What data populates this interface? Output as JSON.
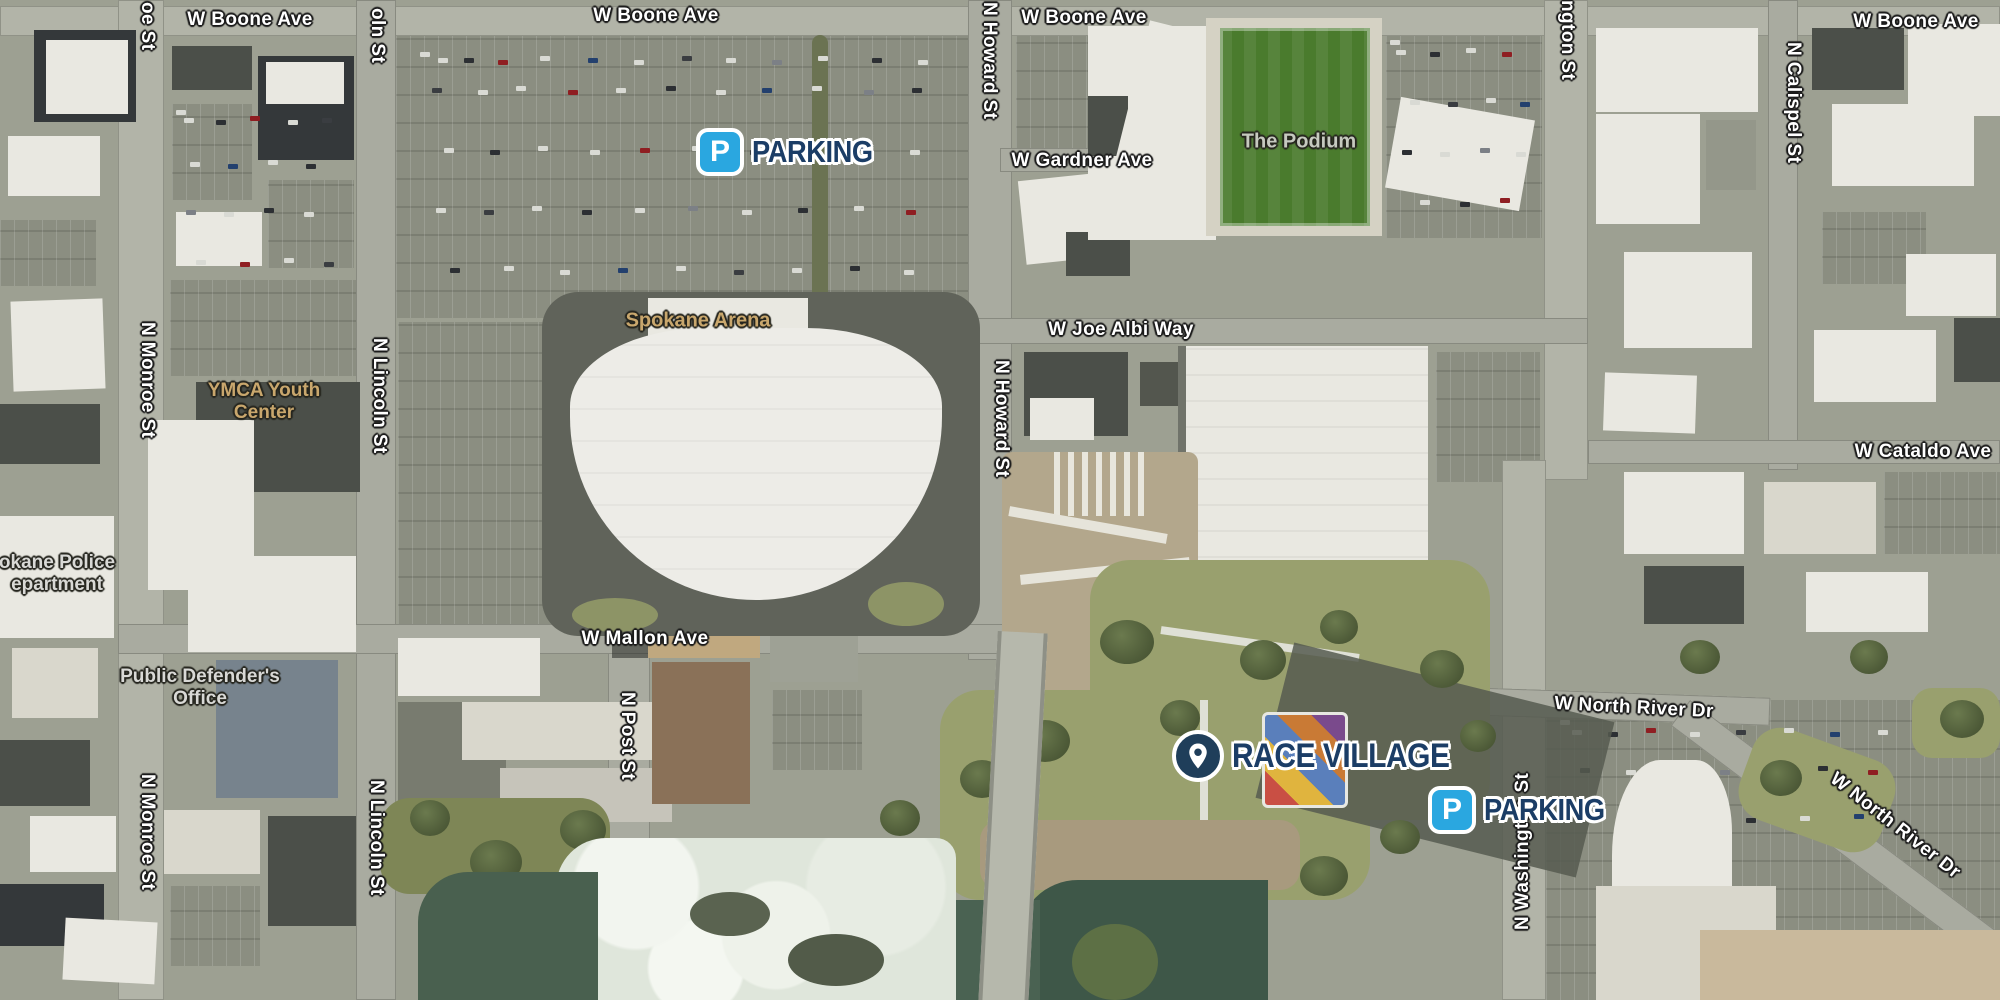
{
  "streets": {
    "boone_1": "W Boone Ave",
    "boone_2": "W Boone Ave",
    "boone_3": "W Boone Ave",
    "boone_4": "W Boone Ave",
    "gardner": "W Gardner Ave",
    "joe_albi": "W Joe Albi Way",
    "cataldo": "W Cataldo Ave",
    "mallon": "W Mallon Ave",
    "north_river_h": "W North River Dr",
    "north_river_diag": "W North River Dr",
    "monroe_top": "oe St",
    "monroe_mid": "N Monroe St",
    "monroe_bottom": "N Monroe St",
    "lincoln_top": "oln St",
    "lincoln_mid": "N Lincoln St",
    "lincoln_bottom": "N Lincoln St",
    "post": "N Post St",
    "howard_top": "N Howard St",
    "howard_mid": "N Howard St",
    "washington_top": "ngton St",
    "washington_bottom": "N Washington St",
    "calispel": "N Calispel St"
  },
  "pois": {
    "arena": "Spokane Arena",
    "podium": "The Podium",
    "ymca_line1": "YMCA Youth",
    "ymca_line2": "Center",
    "police_line1": "okane Police",
    "police_line2": "epartment",
    "defender_line1": "Public Defender's",
    "defender_line2": "Office"
  },
  "overlays": {
    "parking_top": {
      "icon": "P",
      "label": "PARKING"
    },
    "parking_bottom": {
      "icon": "P",
      "label": "PARKING"
    },
    "race_village": {
      "icon": "location-pin",
      "label": "RACE VILLAGE"
    }
  },
  "colors": {
    "parking_icon_blue": "#2aa7e0",
    "overlay_navy": "#1b3d66",
    "race_pin_navy": "#1f3e5a",
    "poi_tan": "#c9a76d",
    "field_green": "#4a7b2d"
  }
}
